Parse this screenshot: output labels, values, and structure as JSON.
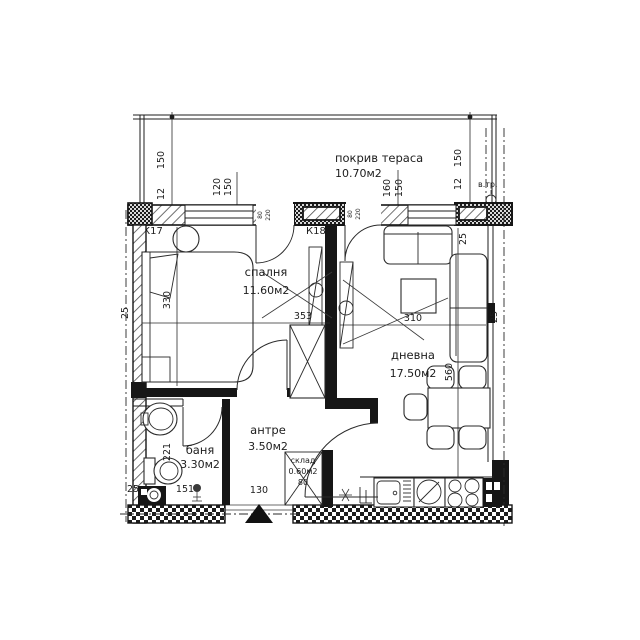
{
  "drawing_type": "apartment floor plan",
  "rooms": {
    "terrace": {
      "name": "покрив тераса",
      "area": "10.70м2"
    },
    "bedroom": {
      "name": "спалня",
      "area": "11.60м2"
    },
    "living": {
      "name": "дневна",
      "area": "17.50м2"
    },
    "hall": {
      "name": "антре",
      "area": "3.50м2"
    },
    "bath": {
      "name": "баня",
      "area": "3.30м2"
    },
    "storage": {
      "name": "склад",
      "area": "0.60м2",
      "width": "80"
    }
  },
  "markers": {
    "k17": "К17",
    "k18": "К18",
    "vent": "в.тр."
  },
  "dims": {
    "d150": "150",
    "d12": "12",
    "d120": "120",
    "d160": "160",
    "d25": "25",
    "bedroom_width": "353",
    "bedroom_depth": "330",
    "living_width": "310",
    "living_depth": "560",
    "hall_width": "130",
    "bath_width": "151",
    "bath_depth": "221",
    "door_w": "80",
    "door_h": "220"
  },
  "colors": {
    "line": "#1d1d1d",
    "background": "#ffffff"
  }
}
